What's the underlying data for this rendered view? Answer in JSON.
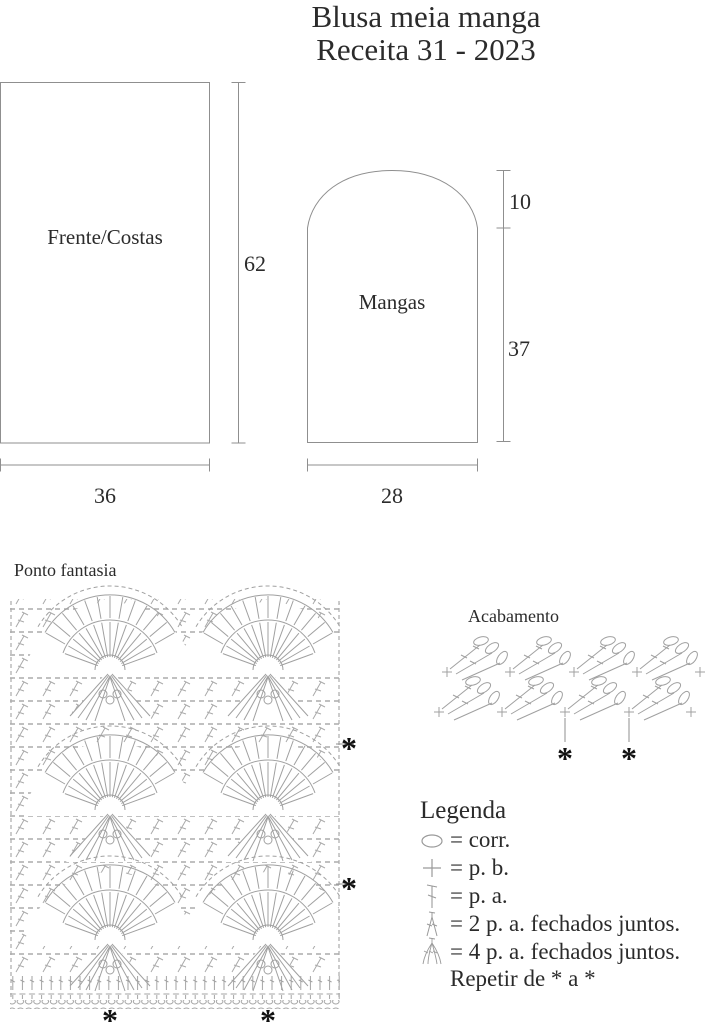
{
  "title": {
    "line1": "Blusa meia manga",
    "line2": "Receita 31 - 2023"
  },
  "pieces": {
    "front_back": {
      "label": "Frente/Costas",
      "height": "62",
      "width": "36"
    },
    "sleeve": {
      "label": "Mangas",
      "cap_height": "10",
      "body_height": "37",
      "width": "28"
    }
  },
  "stitch_chart": {
    "title": "Ponto fantasia",
    "marker": "*"
  },
  "edging_chart": {
    "title": "Acabamento",
    "marker": "*"
  },
  "legend": {
    "title": "Legenda",
    "items": [
      {
        "icon": "chain-icon",
        "text": "= corr."
      },
      {
        "icon": "single-crochet-icon",
        "text": "= p. b."
      },
      {
        "icon": "double-crochet-icon",
        "text": "= p. a."
      },
      {
        "icon": "dc2tog-icon",
        "text": "= 2 p. a. fechados juntos."
      },
      {
        "icon": "dc4tog-icon",
        "text": "= 4 p. a. fechados juntos."
      }
    ],
    "note": "Repetir de * a *"
  },
  "colors": {
    "line": "#9a9a9a",
    "text": "#2b2b2b",
    "marker": "#111111",
    "background": "#ffffff"
  }
}
